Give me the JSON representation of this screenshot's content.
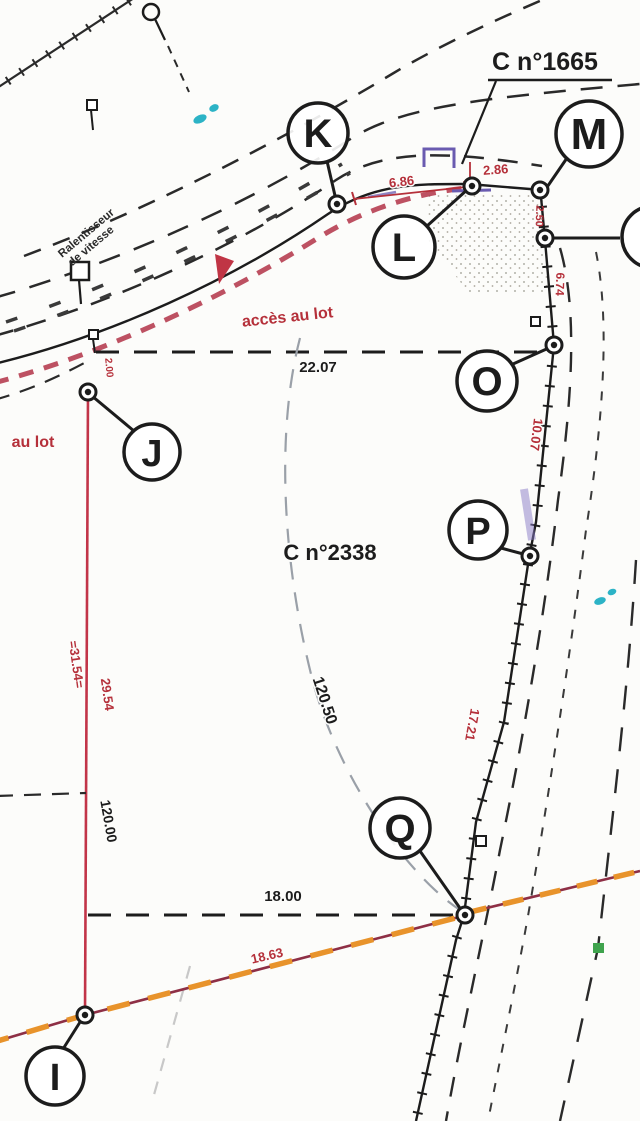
{
  "plan": {
    "parcel_labels": {
      "c1665": "C n°1665",
      "c2338": "C n°2338"
    },
    "annotations": {
      "acces_au_lot": "accès au lot",
      "au_lot": "au lot",
      "ralentisseur_line1": "Ralentisseur",
      "ralentisseur_line2": "de vitesse"
    },
    "points": {
      "I": "I",
      "J": "J",
      "K": "K",
      "L": "L",
      "M": "M",
      "O": "O",
      "P": "P",
      "Q": "Q"
    },
    "measurements": {
      "top_side": "22.07",
      "bottom_side": "18.00",
      "left_side_total": "120.00",
      "left_side_red_a": "=31.54=",
      "left_side_red_b": "29.54",
      "diagonal": "120.50",
      "right_side_a": "10.07",
      "right_side_b": "17.21",
      "road_k_l": "6.86",
      "road_l": "2.86",
      "m_n": "2.50",
      "n_o": "6.74",
      "lower_diagonal": "18.63",
      "j_offset": "2.00"
    },
    "colors": {
      "ink": "#1c1c1c",
      "red_dimension": "#b5303a",
      "red_line": "#c23448",
      "claret_line": "#8e2f45",
      "orange_dash": "#e8932b",
      "purple_mark": "#6a5bb0",
      "cyan_mark": "#2cb3c6",
      "green_mark": "#3fa34d",
      "gray_dash": "#9aa0a8",
      "paper": "#fcfcfa"
    }
  }
}
